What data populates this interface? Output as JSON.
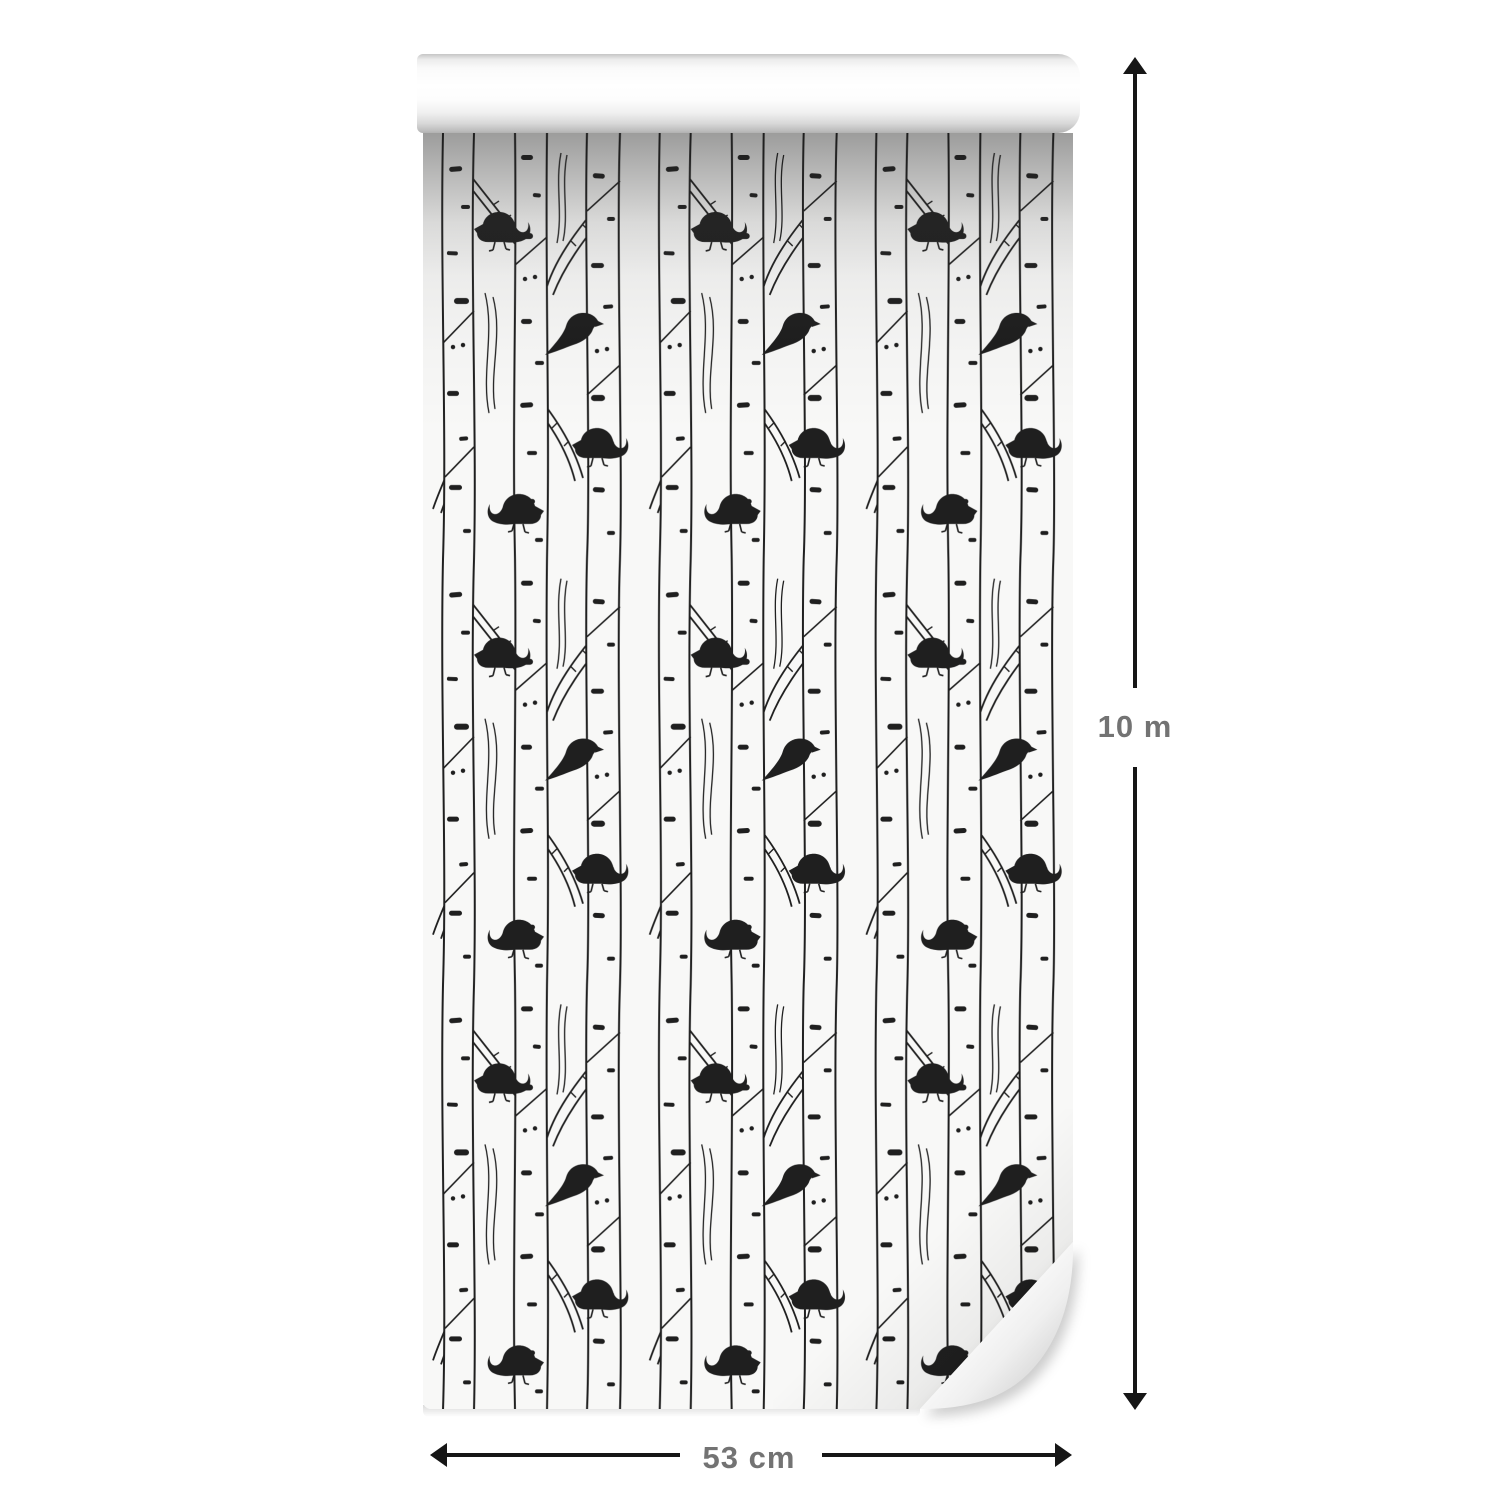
{
  "product": {
    "type": "wallpaper roll",
    "pattern_description": "black and white birch trees with birds"
  },
  "dimensions": {
    "height_label": "10 m",
    "width_label": "53 cm"
  },
  "icons": {
    "vertical_arrow": "double-headed-arrow-vertical",
    "horizontal_arrow": "double-headed-arrow-horizontal"
  },
  "colors": {
    "background": "#ffffff",
    "paper": "#f8f8f7",
    "pattern_ink": "#1f1f1f",
    "arrow": "#161616",
    "label_text": "#737373"
  }
}
